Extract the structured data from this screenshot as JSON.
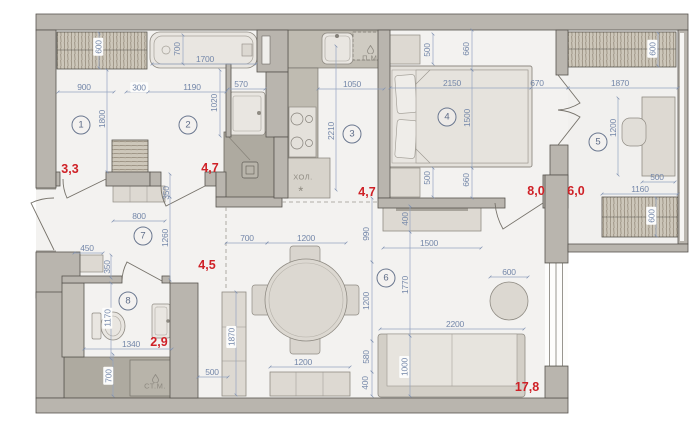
{
  "rooms": [
    {
      "num": "1",
      "area": "3,3"
    },
    {
      "num": "2",
      "area": "4,7"
    },
    {
      "num": "3",
      "area": "4,7"
    },
    {
      "num": "4",
      "area": "8,0"
    },
    {
      "num": "5",
      "area": "6,0"
    },
    {
      "num": "6",
      "area": "17,8"
    },
    {
      "num": "7",
      "area": "4,5"
    },
    {
      "num": "8",
      "area": "2,9"
    }
  ],
  "appliances": {
    "dishwasher_label": "П.М.",
    "fridge_label": "ХОЛ.",
    "fridge_symbol": "*",
    "washing_machine_label": "СТ.М."
  },
  "dims": {
    "r1_wardrobe_depth": "600",
    "r1_width": "900",
    "r1_height": "1800",
    "niche_width": "300",
    "r2_width": "1190",
    "tub_width": "700",
    "tub_length": "1700",
    "basin_width": "570",
    "r2_height": "1020",
    "kitchen_width": "1050",
    "kitchen_depth": "2210",
    "nightstand_top": "500",
    "bed_gap_top": "660",
    "bed_length": "2150",
    "bed_width": "1500",
    "bed_to_wall": "670",
    "balcony_width": "1870",
    "balcony_wardrobe_top": "600",
    "desk_length": "1200",
    "desk_depth": "500",
    "balcony_inner_width": "1160",
    "balcony_wardrobe_bottom": "600",
    "nightstand_bottom": "500",
    "bed_gap_bottom": "660",
    "tv_depth": "400",
    "tv_length": "1500",
    "living_depth_990": "990",
    "living_depth_1770": "1770",
    "pouf_diameter": "600",
    "sofa_length": "2200",
    "sofa_depth": "1000",
    "sofa_gap": "580",
    "sideboard_depth": "400",
    "sideboard_length": "1200",
    "table_offset": "700",
    "table_length": "1200",
    "table_width": "1200",
    "cabinet_length": "1870",
    "passage_width": "500",
    "bench_length": "800",
    "bench_depth": "350",
    "hall_length": "1260",
    "hall_cabinet": "450",
    "hall_cabinet_depth": "350",
    "wc_depth": "1170",
    "wc_width": "1340",
    "wet_zone_depth": "700"
  },
  "colors": {
    "area_label": "#cf2127",
    "dimension_label": "#7487a9",
    "wall_fill": "#b9b5ae",
    "floor_fill": "#f3f2f0"
  }
}
